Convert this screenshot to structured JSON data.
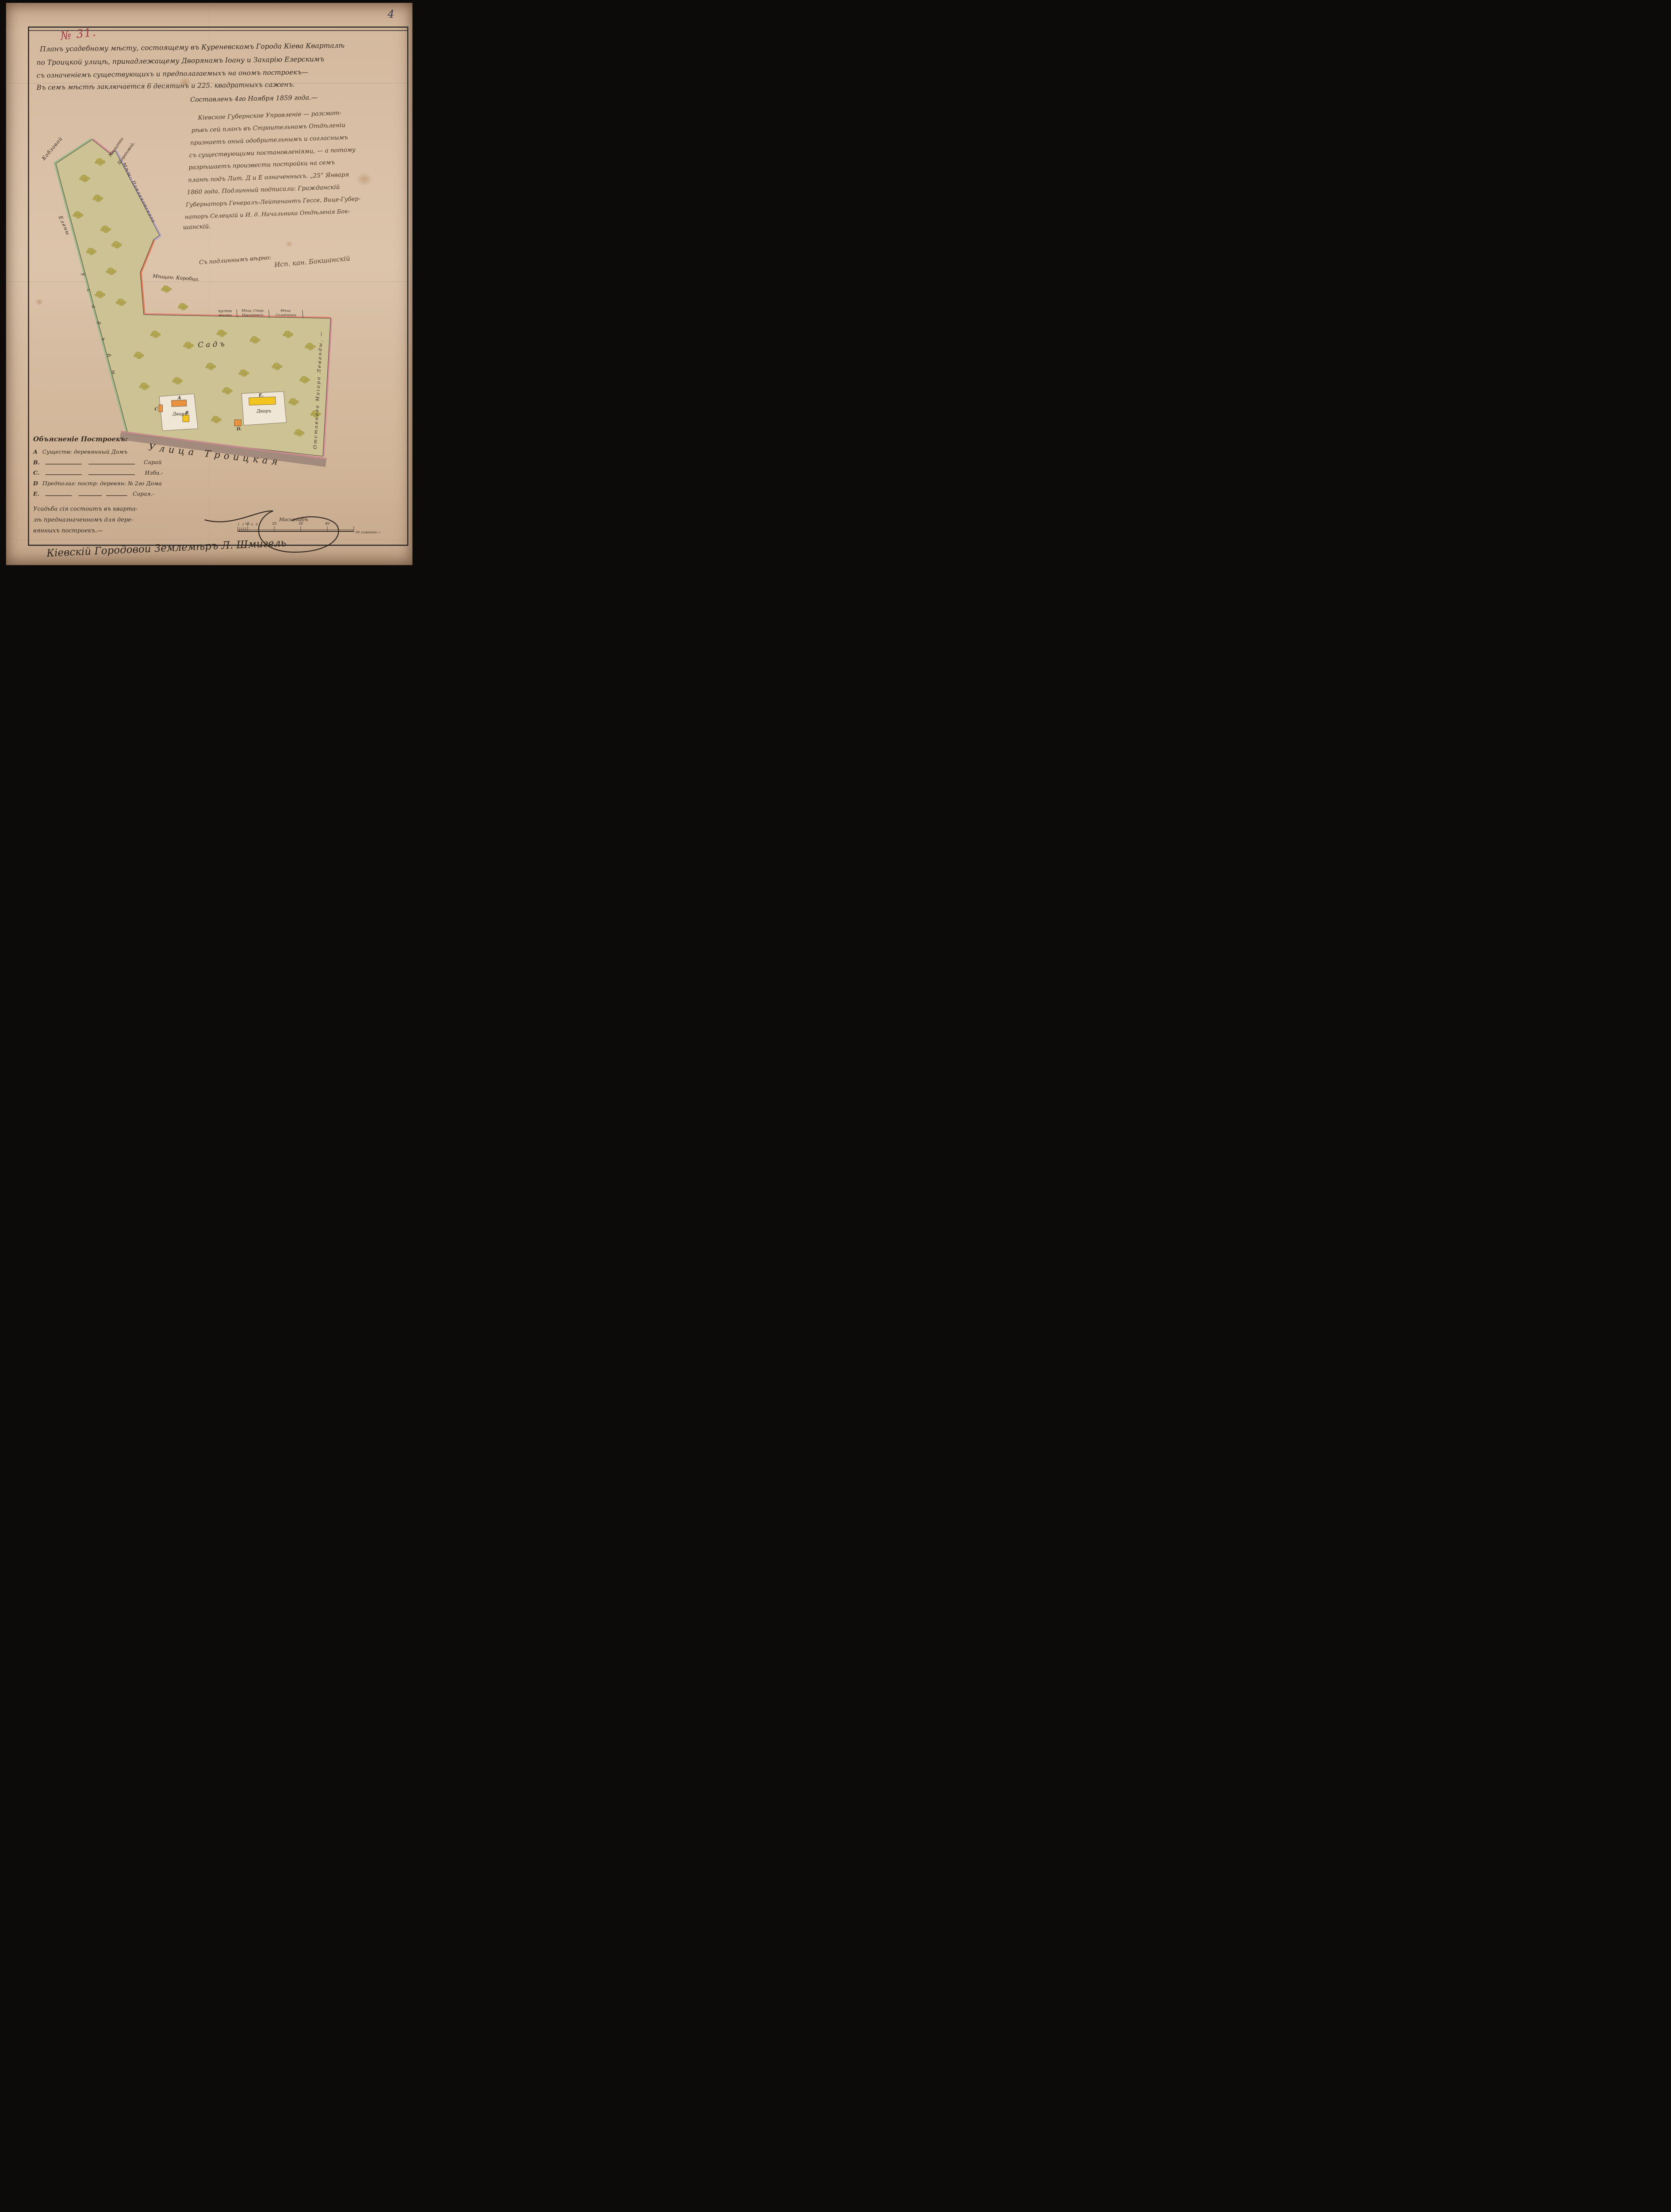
{
  "page": {
    "corner_number": "4",
    "doc_number": "№ 31."
  },
  "header": {
    "line1": "Планъ усадебному мѣсту, состоящему въ Куреневскомъ Города Кіева Кварталѣ",
    "line2": "по Троицкой улицѣ, принадлежащему Дворянамъ Іоану и Захарію Езерскимъ",
    "line3": "съ означеніемъ существующихъ и предполагаемыхъ на ономъ построекъ—",
    "line4": "Въ семъ мѣстѣ заключается 6 десятинъ и 225. квадратныхъ саженъ.",
    "date_line": "Составленъ 4го Ноября 1859 года.—"
  },
  "resolution": {
    "lines": [
      "Кіевское Губернское Управленіе — разсмот-",
      "рѣвъ сей планъ въ Строительномъ Отдѣленіи",
      "признаетъ оный одобрительнымъ и согласнымъ",
      "съ существующими постановленіями, — а потому",
      "разрѣшаетъ произвести постройки на семъ",
      "планѣ подъ Лит. Д и Е означенныхъ. „25“ Января",
      "1860 года. Подлинный подписали: Гражданскій",
      "Губернаторъ Генералъ-Лейтенантъ Гессе, Вице-Губер-",
      "наторъ Селецкій и И. д. Начальника Отдѣленія Бок-",
      "шанскій."
    ],
    "certification": "Съ подлиннымъ вѣрно:",
    "certification_signature": "Исп. кан. Бокшанскій"
  },
  "map": {
    "labels": {
      "neighbor_left_surname": "Кобзовой",
      "neighbor_left_name": "Елены",
      "neighbor_left_word": "у с а д ь б ы",
      "neighbor_top_line1": "Мѣщанки",
      "neighbor_top_line2": "Шороховой.",
      "neighbor_right_upper": "Мѣщ: Павликовского",
      "neighbor_korobets": "Мѣщан: Коробца.",
      "vacant_line1": "пустое",
      "vacant_line2": "мѣсто",
      "pavlikovsky2_line1": "Мѣщ: Стар:",
      "pavlikovsky2_line2": "Павликовск:",
      "solodchenko_line1": "Мѣщ:",
      "solodchenko_line2": "Солодченка",
      "neighbor_levanda": "Отставнаго Маіора Леванды. —",
      "garden": "Садъ",
      "street": "Улица Троицкая",
      "yard1": "Дворъ",
      "yard2": "Дворъ"
    },
    "buildings": {
      "a": "А",
      "b": "В",
      "c": "С",
      "d": "D.",
      "e": "Е."
    },
    "scale_bar": {
      "title": "Масштабъ",
      "minor_labels": "1 2 4 6 8",
      "tick_10": "10.",
      "tick_20": "20",
      "tick_30": "30",
      "tick_40": "40",
      "unit_label": "50 саженей.—"
    }
  },
  "legend": {
    "title": "Объясненіе Построекъ:",
    "items": [
      {
        "letter": "A",
        "text": "Существ: деревянный Домъ"
      },
      {
        "letter": "B.",
        "text": "Сарай"
      },
      {
        "letter": "C.",
        "text": "Изба.-"
      },
      {
        "letter": "D",
        "text": "Предполаг: постр: деревян: № 2го Дома"
      },
      {
        "letter": "E.",
        "text": "Сарая.-"
      }
    ],
    "note_lines": [
      "Усадьба сія состоитъ въ кварта-",
      "лѣ предназначенномъ для дере-",
      "вянныхъ построекъ.—"
    ]
  },
  "footer": {
    "surveyor_signature": "Кіевскій Городовой Землемѣръ Л. Шмигель"
  },
  "colors": {
    "paper": "#d9c0a6",
    "plot_fill": "#cdc294",
    "tree": "#b3a851",
    "green_edge": "#9eb88a",
    "pink_edge": "#d68f97",
    "violet_edge": "#b5a6c4",
    "orange_edge": "#df7b58",
    "street_fill": "#9a8377",
    "yellow_building": "#f2c41d",
    "orange_building": "#e8923f",
    "red_ink": "#a83c4a",
    "ink": "#33291f"
  }
}
